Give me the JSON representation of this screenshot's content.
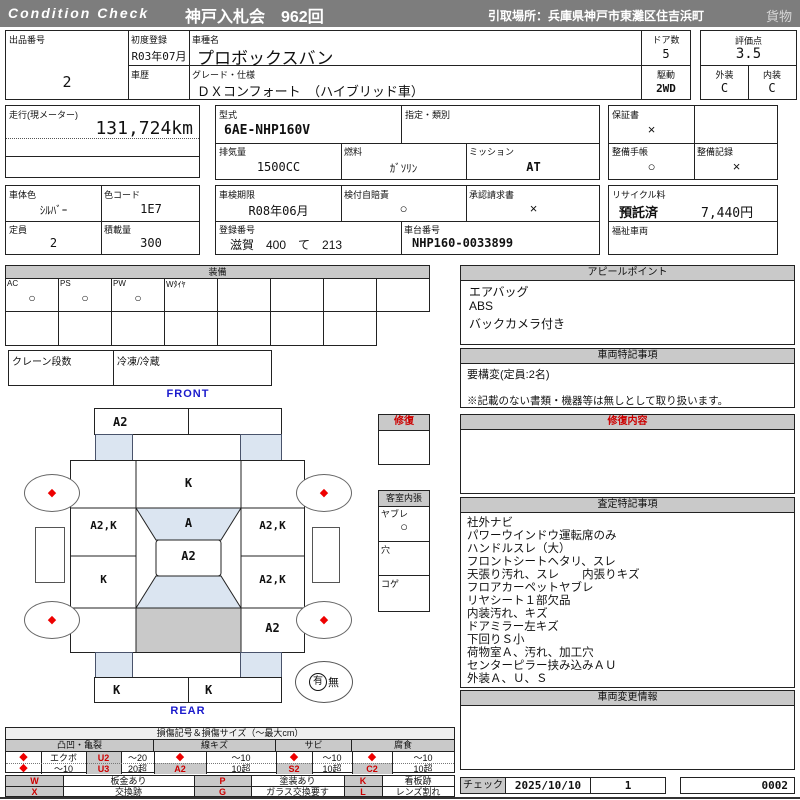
{
  "colors": {
    "bar": "#7d7d7d",
    "accent_red": "#cc0000",
    "label_blue": "#1a1acc",
    "panel_gray": "#c9c9c9",
    "glass_blue": "#dbe5f1"
  },
  "header": {
    "brand": "Condition  Check",
    "auction": "神戸入札会　962回",
    "pickup": "引取場所：兵庫県神戸市東灘区住吉浜町",
    "cargo": "貨物"
  },
  "t1": {
    "lot_label": "出品番号",
    "lot": "2",
    "first_reg_label": "初度登録",
    "first_reg": "R03年07月",
    "model_label": "車種名",
    "model": "プロボックスバン",
    "doors_label": "ドア数",
    "doors": "5",
    "history_label": "車歴",
    "grade_label": "グレード・仕様",
    "grade": "ＤＸコンフォート　（ハイブリッド車）",
    "drive_label": "駆動",
    "drive": "2WD",
    "score_label": "評価点",
    "score": "3.5",
    "ext_label": "外装",
    "ext": "C",
    "int_label": "内装",
    "int": "C"
  },
  "t2": {
    "odo_label": "走行(現メーター)",
    "odo": "131,724km",
    "model_code_label": "型式",
    "model_code": "6AE-NHP160V",
    "class_label": "指定・類別",
    "warranty_label": "保証書",
    "warranty": "×",
    "disp_label": "排気量",
    "disp": "1500CC",
    "fuel_label": "燃料",
    "fuel": "ｶﾞｿﾘﾝ",
    "trans_label": "ミッション",
    "trans": "AT",
    "maint_book_label": "整備手帳",
    "maint_book": "○",
    "maint_rec_label": "整備記録",
    "maint_rec": "×"
  },
  "t3": {
    "color_label": "車体色",
    "color": "ｼﾙﾊﾞｰ",
    "color_code_label": "色コード",
    "color_code": "1E7",
    "capacity_label": "定員",
    "capacity": "2",
    "load_label": "積載量",
    "load": "300",
    "inspection_label": "車検期限",
    "inspection": "R08年06月",
    "insurance_label": "検付自賠責",
    "insurance": "○",
    "approval_label": "承認請求書",
    "approval": "×",
    "recycle_label": "リサイクル料",
    "recycle_status": "預託済",
    "recycle_fee": "7,440円",
    "reg_no_label": "登録番号",
    "reg_no": "滋賀　400　て　213",
    "chassis_label": "車台番号",
    "chassis": "NHP160-0033899",
    "welfare_label": "福祉車両"
  },
  "equip": {
    "title": "装備",
    "cols": [
      "AC",
      "PS",
      "PW",
      "Wﾀｲﾔ",
      "",
      "",
      "",
      ""
    ],
    "vals": [
      "○",
      "○",
      "○",
      "",
      "",
      "",
      "",
      ""
    ],
    "crane_label": "クレーン段数",
    "fridge_label": "冷凍/冷蔵"
  },
  "appeal": {
    "title": "アピールポイント",
    "lines": [
      "エアバッグ",
      "ABS",
      "バックカメラ付き"
    ]
  },
  "notes": {
    "title": "車両特記事項",
    "line1": "要構変(定員:2名)",
    "disclaimer": "※記載のない書類・機器等は無しとして取り扱います。"
  },
  "repair": {
    "title": "修復内容"
  },
  "assess": {
    "title": "査定特記事項",
    "lines": [
      "社外ナビ",
      "パワーウインドウ運転席のみ",
      "ハンドルスレ（大）",
      "フロントシートヘタリ、スレ",
      "天張り汚れ、スレ　　内張りキズ",
      "フロアカーペットヤブレ",
      "リヤシート１部欠品",
      "内装汚れ、キズ",
      "ドアミラー左キズ",
      "下回りＳ小",
      "荷物室Ａ、汚れ、加工穴",
      "センターピラー挟み込みＡＵ",
      "外装Ａ、Ｕ、Ｓ"
    ]
  },
  "change": {
    "title": "車両変更情報"
  },
  "check": {
    "label": "チェック",
    "date": "2025/10/10",
    "count": "1",
    "number": "0002"
  },
  "diagram": {
    "front": "FRONT",
    "rear": "REAR",
    "diamond": "◆",
    "top_bumper_left": "A2",
    "hood": "K",
    "windshield": "A",
    "roof": "A2",
    "left_mid": "A2,K",
    "left_lower": "K",
    "right_mid": "A2,K",
    "right_lower": "A2,K",
    "right_bottom": "A2",
    "bottom_bumper_left": "K",
    "bottom_bumper_right": "K",
    "spare_yes": "有",
    "spare_no": "無",
    "repair_title": "修復",
    "cabin_title": "客室内張",
    "cabin_rows": [
      {
        "label": "ヤブレ",
        "val": "○"
      },
      {
        "label": "穴",
        "val": ""
      },
      {
        "label": "コゲ",
        "val": ""
      }
    ]
  },
  "legend": {
    "title": "損傷記号＆損傷サイズ（～最大cm）",
    "diamond": "◆",
    "g1": {
      "name": "凸凹・亀裂",
      "r1": {
        "t": "エクボ",
        "code": "U2",
        "size": "～20"
      },
      "r2": {
        "t": "～10",
        "code": "U3",
        "size": "20超"
      }
    },
    "g2": {
      "name": "線キズ",
      "r1": {
        "size": "～10"
      },
      "r2": {
        "code": "A2",
        "size": "10超"
      }
    },
    "g3": {
      "name": "サビ",
      "r1": {
        "size": "～10"
      },
      "r2": {
        "code": "S2",
        "size": "10超"
      }
    },
    "g4": {
      "name": "腐食",
      "r1": {
        "size": "～10"
      },
      "r2": {
        "code": "C2",
        "size": "10超"
      }
    },
    "codes": {
      "w": "W",
      "w_t": "板金あり",
      "x": "X",
      "x_t": "交換跡",
      "p": "P",
      "p_t": "塗装あり",
      "g": "G",
      "g_t": "ガラス交換要す",
      "k": "K",
      "k_t": "看板跡",
      "l": "L",
      "l_t": "レンズ割れ"
    }
  }
}
